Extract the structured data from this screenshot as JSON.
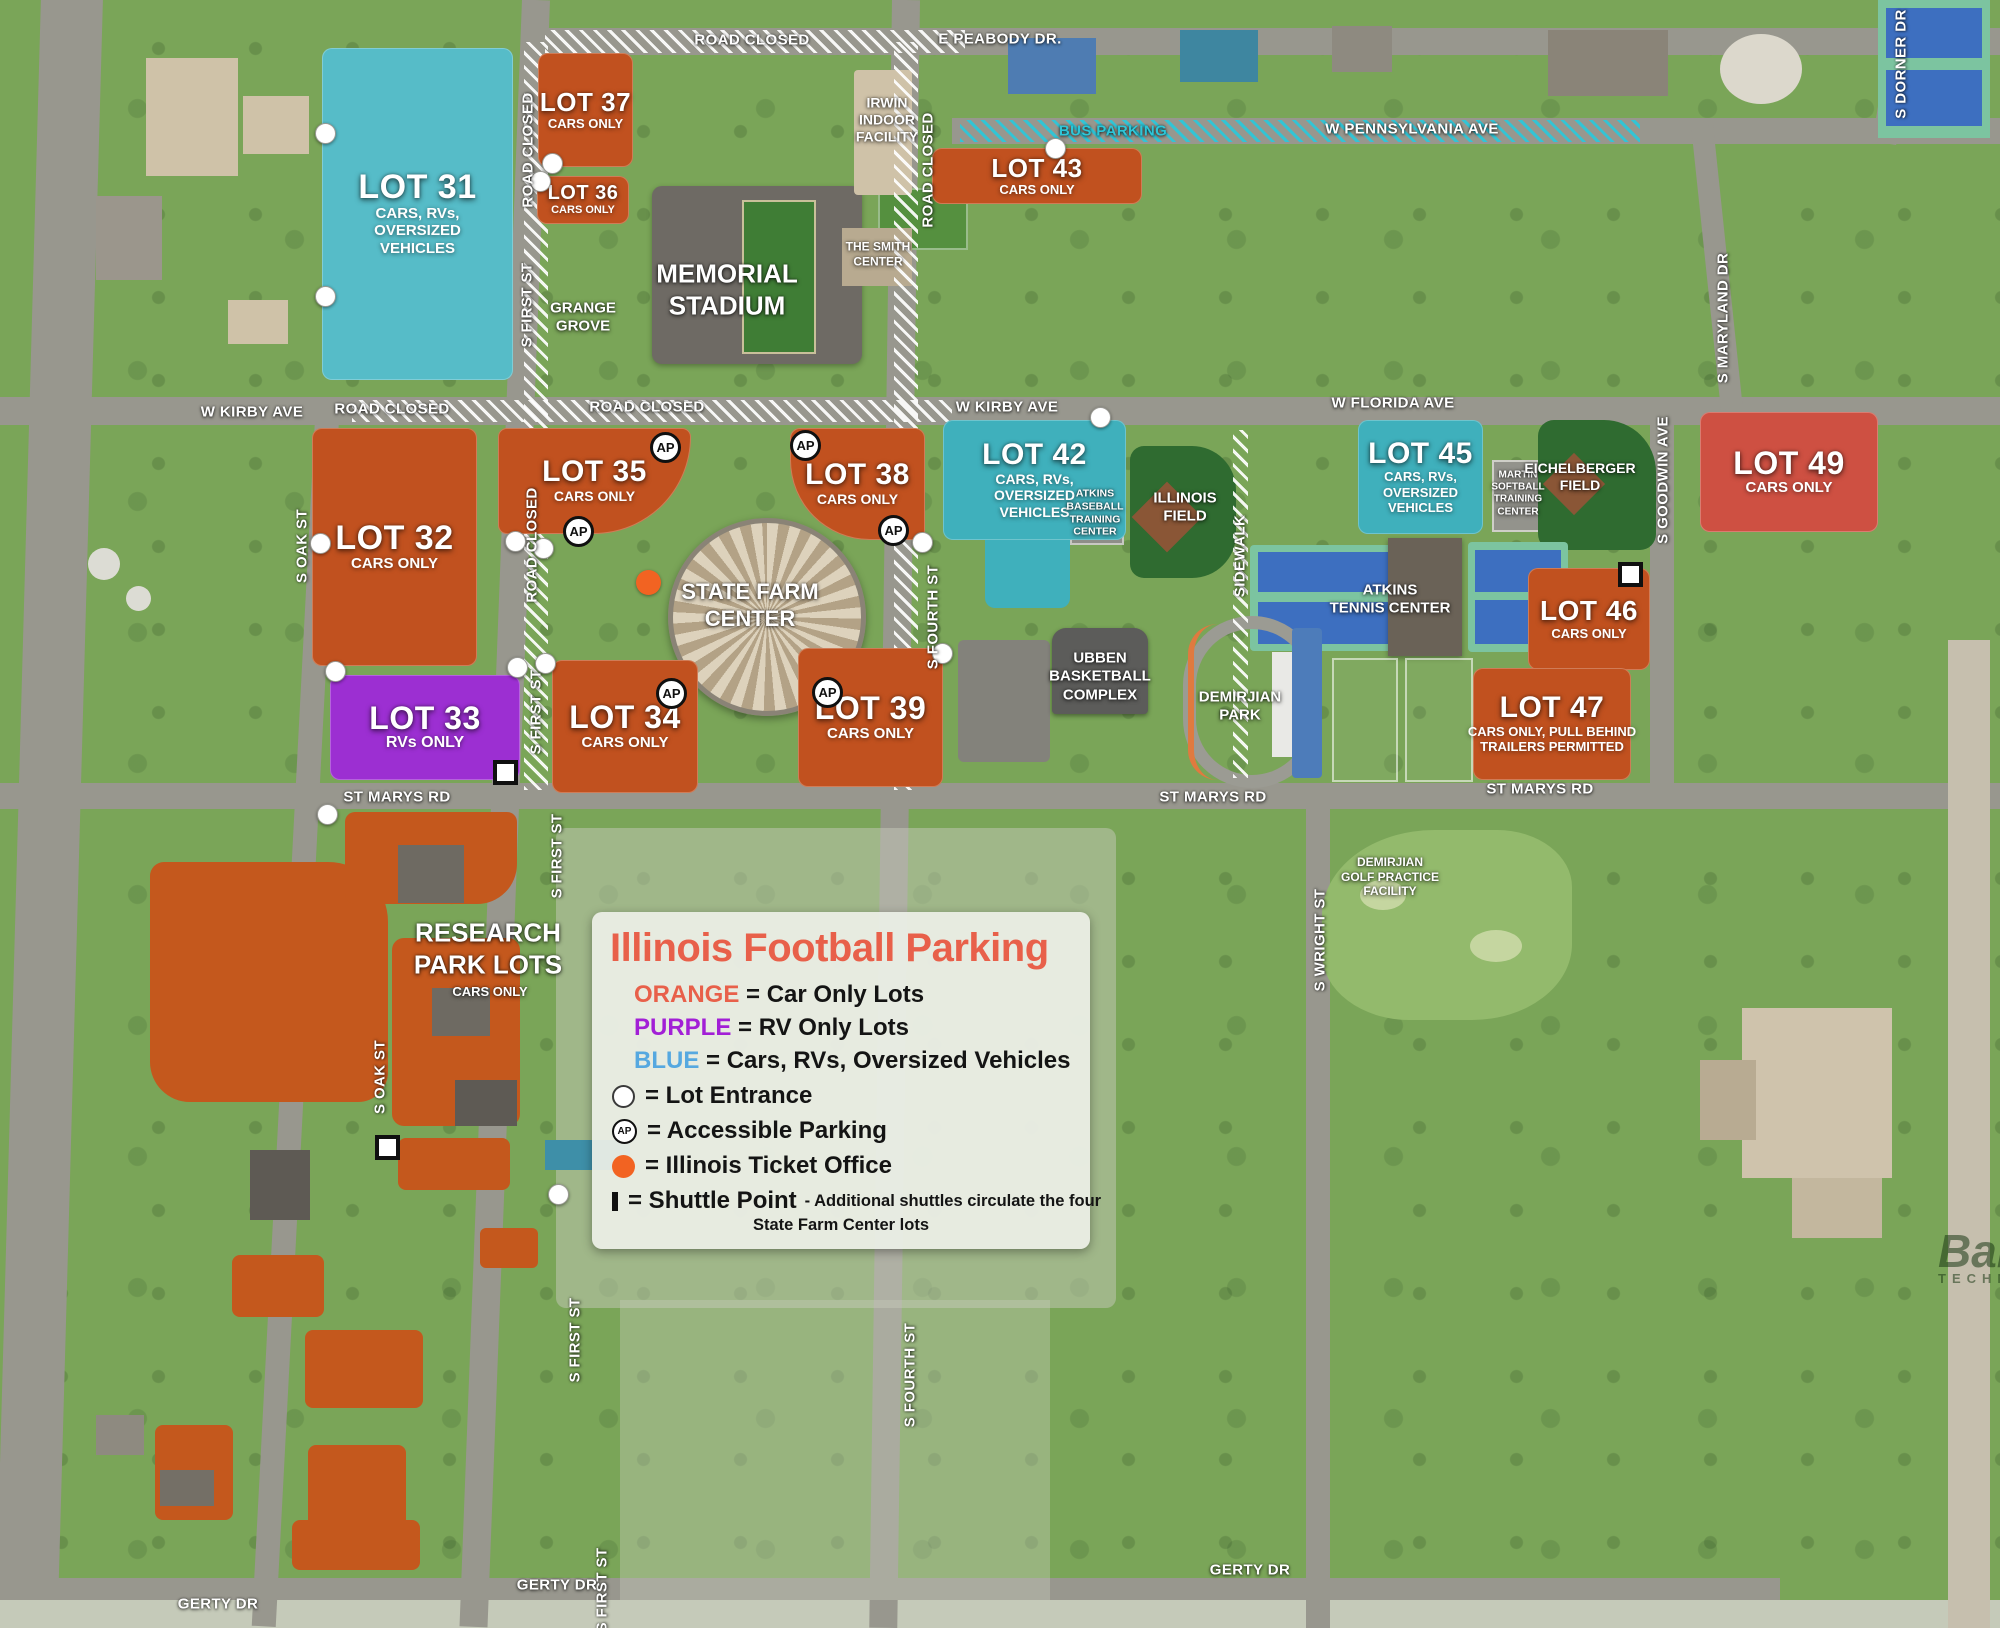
{
  "legend": {
    "title": "Illinois Football Parking",
    "title_color": "#e8604a",
    "color_entries": [
      {
        "word": "ORANGE",
        "color": "#e8604a",
        "desc": "= Car Only Lots"
      },
      {
        "word": "PURPLE",
        "color": "#a21fd6",
        "desc": "= RV Only Lots"
      },
      {
        "word": "BLUE",
        "color": "#56a8e0",
        "desc": "= Cars, RVs, Oversized Vehicles"
      }
    ],
    "symbol_entries": [
      {
        "icon": "lot-entrance",
        "desc": "= Lot Entrance"
      },
      {
        "icon": "accessible-parking",
        "icon_text": "AP",
        "desc": "= Accessible Parking"
      },
      {
        "icon": "ticket-office",
        "desc": "= Illinois Ticket Office"
      },
      {
        "icon": "shuttle-point",
        "desc": "= Shuttle Point",
        "note1": "- Additional shuttles circulate the four",
        "note2": "State Farm Center lots"
      }
    ]
  },
  "colors": {
    "orange_lot": "#c1511f",
    "red_lot": "#ce5042",
    "blue_lot": "#56bcc8",
    "teal_lot": "#3fb0bc",
    "purple_lot": "#9c2fd2",
    "road": "#98978e",
    "bus_parking": "#2ec6d8",
    "ticket_dot": "#f26322"
  },
  "lots": [
    {
      "id": "31",
      "name": "LOT 31",
      "sub": [
        "CARS, RVs,",
        "OVERSIZED",
        "VEHICLES"
      ],
      "type": "blue",
      "x": 322,
      "y": 48,
      "w": 191,
      "h": 332,
      "fs": 34,
      "sfs": 15
    },
    {
      "id": "37",
      "name": "LOT 37",
      "sub": [
        "CARS ONLY"
      ],
      "type": "orange",
      "x": 538,
      "y": 53,
      "w": 95,
      "h": 114,
      "fs": 26,
      "sfs": 13
    },
    {
      "id": "36",
      "name": "LOT 36",
      "sub": [
        "CARS ONLY"
      ],
      "type": "orange",
      "x": 537,
      "y": 176,
      "w": 92,
      "h": 48,
      "fs": 20,
      "sfs": 11
    },
    {
      "id": "43",
      "name": "LOT 43",
      "sub": [
        "CARS ONLY"
      ],
      "type": "orange",
      "x": 932,
      "y": 148,
      "w": 210,
      "h": 56,
      "fs": 26,
      "sfs": 13
    },
    {
      "id": "32",
      "name": "LOT 32",
      "sub": [
        "CARS ONLY"
      ],
      "type": "orange",
      "x": 312,
      "y": 428,
      "w": 165,
      "h": 238,
      "fs": 34,
      "sfs": 15
    },
    {
      "id": "35",
      "name": "LOT 35",
      "sub": [
        "CARS ONLY"
      ],
      "type": "orange",
      "x": 498,
      "y": 428,
      "w": 193,
      "h": 106,
      "fs": 30,
      "sfs": 14,
      "br": "10px 10px 110px 10px"
    },
    {
      "id": "38",
      "name": "LOT 38",
      "sub": [
        "CARS ONLY"
      ],
      "type": "orange",
      "x": 790,
      "y": 428,
      "w": 135,
      "h": 112,
      "fs": 30,
      "sfs": 14,
      "br": "10px 10px 10px 80px"
    },
    {
      "id": "42",
      "name": "LOT 42",
      "sub": [
        "CARS, RVs,",
        "OVERSIZED",
        "VEHICLES"
      ],
      "type": "teal",
      "x": 943,
      "y": 420,
      "w": 183,
      "h": 120,
      "fs": 30,
      "sfs": 14
    },
    {
      "id": "45",
      "name": "LOT 45",
      "sub": [
        "CARS, RVs,",
        "OVERSIZED",
        "VEHICLES"
      ],
      "type": "teal",
      "x": 1358,
      "y": 420,
      "w": 125,
      "h": 114,
      "fs": 30,
      "sfs": 13
    },
    {
      "id": "49",
      "name": "LOT 49",
      "sub": [
        "CARS ONLY"
      ],
      "type": "red",
      "x": 1700,
      "y": 412,
      "w": 178,
      "h": 120,
      "fs": 32,
      "sfs": 15
    },
    {
      "id": "33",
      "name": "LOT 33",
      "sub": [
        "RVs ONLY"
      ],
      "type": "purple",
      "x": 330,
      "y": 675,
      "w": 190,
      "h": 105,
      "fs": 32,
      "sfs": 16
    },
    {
      "id": "34",
      "name": "LOT 34",
      "sub": [
        "CARS ONLY"
      ],
      "type": "orange",
      "x": 552,
      "y": 660,
      "w": 146,
      "h": 133,
      "fs": 32,
      "sfs": 15
    },
    {
      "id": "39",
      "name": "LOT 39",
      "sub": [
        "CARS ONLY"
      ],
      "type": "orange",
      "x": 798,
      "y": 648,
      "w": 145,
      "h": 139,
      "fs": 32,
      "sfs": 15
    },
    {
      "id": "46",
      "name": "LOT 46",
      "sub": [
        "CARS ONLY"
      ],
      "type": "orange",
      "x": 1528,
      "y": 568,
      "w": 122,
      "h": 102,
      "fs": 28,
      "sfs": 13
    },
    {
      "id": "47",
      "name": "LOT 47",
      "sub": [
        "CARS ONLY, PULL BEHIND",
        "TRAILERS PERMITTED"
      ],
      "type": "orange",
      "x": 1473,
      "y": 668,
      "w": 158,
      "h": 112,
      "fs": 30,
      "sfs": 13
    }
  ],
  "street_labels": [
    {
      "t": "ROAD CLOSED",
      "x": 752,
      "y": 40
    },
    {
      "t": "E PEABODY DR.",
      "x": 1000,
      "y": 39
    },
    {
      "t": "BUS PARKING",
      "x": 1113,
      "y": 131,
      "c": "#2ec6d8"
    },
    {
      "t": "W PENNSYLVANIA AVE",
      "x": 1412,
      "y": 129
    },
    {
      "t": "S DORNER DR",
      "x": 1901,
      "y": 64,
      "r": -90
    },
    {
      "t": "S MARYLAND DR",
      "x": 1723,
      "y": 318,
      "r": -90
    },
    {
      "t": "W KIRBY AVE",
      "x": 252,
      "y": 412
    },
    {
      "t": "ROAD CLOSED",
      "x": 392,
      "y": 409
    },
    {
      "t": "ROAD CLOSED",
      "x": 647,
      "y": 407
    },
    {
      "t": "W KIRBY AVE",
      "x": 1007,
      "y": 407
    },
    {
      "t": "W FLORIDA AVE",
      "x": 1393,
      "y": 403
    },
    {
      "t": "ROAD CLOSED",
      "x": 528,
      "y": 150,
      "r": -90
    },
    {
      "t": "S FIRST ST",
      "x": 527,
      "y": 305,
      "r": -90
    },
    {
      "t": "ROAD CLOSED",
      "x": 532,
      "y": 545,
      "r": -90
    },
    {
      "t": "S FIRST ST",
      "x": 536,
      "y": 712,
      "r": -90
    },
    {
      "t": "S FIRST ST",
      "x": 557,
      "y": 856,
      "r": -90
    },
    {
      "t": "S FIRST ST",
      "x": 575,
      "y": 1340,
      "r": -90
    },
    {
      "t": "S FIRST ST",
      "x": 602,
      "y": 1590,
      "r": -90
    },
    {
      "t": "ROAD CLOSED",
      "x": 928,
      "y": 170,
      "r": -90
    },
    {
      "t": "S FOURTH ST",
      "x": 933,
      "y": 617,
      "r": -90
    },
    {
      "t": "S FOURTH ST",
      "x": 910,
      "y": 1375,
      "r": -90
    },
    {
      "t": "S OAK ST",
      "x": 302,
      "y": 546,
      "r": -90
    },
    {
      "t": "S OAK ST",
      "x": 380,
      "y": 1077,
      "r": -90
    },
    {
      "t": "SIDEWALK",
      "x": 1240,
      "y": 556,
      "r": -90
    },
    {
      "t": "S GOODWIN AVE",
      "x": 1663,
      "y": 480,
      "r": -90
    },
    {
      "t": "ST MARYS RD",
      "x": 397,
      "y": 797
    },
    {
      "t": "ST MARYS RD",
      "x": 1213,
      "y": 797
    },
    {
      "t": "ST MARYS RD",
      "x": 1540,
      "y": 789
    },
    {
      "t": "S WRIGHT ST",
      "x": 1320,
      "y": 940,
      "r": -90
    },
    {
      "t": "GERTY DR",
      "x": 218,
      "y": 1604
    },
    {
      "t": "GERTY DR",
      "x": 557,
      "y": 1585
    },
    {
      "t": "GERTY DR",
      "x": 1250,
      "y": 1570
    }
  ],
  "place_labels": [
    {
      "lines": [
        "MEMORIAL",
        "STADIUM"
      ],
      "x": 727,
      "y": 290,
      "fs": 26
    },
    {
      "lines": [
        "GRANGE",
        "GROVE"
      ],
      "x": 583,
      "y": 318,
      "fs": 15
    },
    {
      "lines": [
        "IRWIN",
        "INDOOR",
        "FACILITY"
      ],
      "x": 887,
      "y": 120,
      "fs": 14
    },
    {
      "lines": [
        "THE SMITH",
        "CENTER"
      ],
      "x": 878,
      "y": 254,
      "fs": 12
    },
    {
      "lines": [
        "STATE FARM",
        "CENTER"
      ],
      "x": 750,
      "y": 606,
      "fs": 22
    },
    {
      "lines": [
        "ATKINS",
        "BASEBALL",
        "TRAINING",
        "CENTER"
      ],
      "x": 1095,
      "y": 513,
      "fs": 10.5
    },
    {
      "lines": [
        "ILLINOIS",
        "FIELD"
      ],
      "x": 1185,
      "y": 508,
      "fs": 15
    },
    {
      "lines": [
        "MARTIN",
        "SOFTBALL",
        "TRAINING",
        "CENTER"
      ],
      "x": 1518,
      "y": 494,
      "fs": 10
    },
    {
      "lines": [
        "EICHELBERGER",
        "FIELD"
      ],
      "x": 1580,
      "y": 477,
      "fs": 14
    },
    {
      "lines": [
        "ATKINS",
        "TENNIS CENTER"
      ],
      "x": 1390,
      "y": 600,
      "fs": 15
    },
    {
      "lines": [
        "UBBEN",
        "BASKETBALL",
        "COMPLEX"
      ],
      "x": 1100,
      "y": 677,
      "fs": 15
    },
    {
      "lines": [
        "DEMIRJIAN",
        "PARK"
      ],
      "x": 1240,
      "y": 707,
      "fs": 15
    },
    {
      "lines": [
        "DEMIRJIAN",
        "GOLF PRACTICE",
        "FACILITY"
      ],
      "x": 1390,
      "y": 877,
      "fs": 12
    },
    {
      "lines": [
        "RESEARCH",
        "PARK LOTS"
      ],
      "x": 488,
      "y": 949,
      "fs": 26
    },
    {
      "lines": [
        "CARS ONLY"
      ],
      "x": 490,
      "y": 992,
      "fs": 13
    }
  ],
  "markers": {
    "entrances": [
      [
        325,
        133
      ],
      [
        325,
        296
      ],
      [
        552,
        163
      ],
      [
        540,
        181
      ],
      [
        1055,
        148
      ],
      [
        1100,
        417
      ],
      [
        320,
        543
      ],
      [
        515,
        541
      ],
      [
        543,
        548
      ],
      [
        335,
        671
      ],
      [
        517,
        667
      ],
      [
        545,
        663
      ],
      [
        922,
        542
      ],
      [
        942,
        653
      ],
      [
        327,
        814
      ],
      [
        558,
        1194
      ]
    ],
    "accessible": [
      [
        665,
        447
      ],
      [
        805,
        445
      ],
      [
        578,
        531
      ],
      [
        893,
        530
      ],
      [
        671,
        693
      ],
      [
        827,
        692
      ]
    ],
    "shuttles": [
      [
        505,
        772
      ],
      [
        1630,
        574
      ],
      [
        387,
        1147
      ]
    ],
    "ticket": [
      [
        648,
        582
      ]
    ]
  },
  "watermark": {
    "line1": "Bal",
    "line2": "TECHN"
  }
}
